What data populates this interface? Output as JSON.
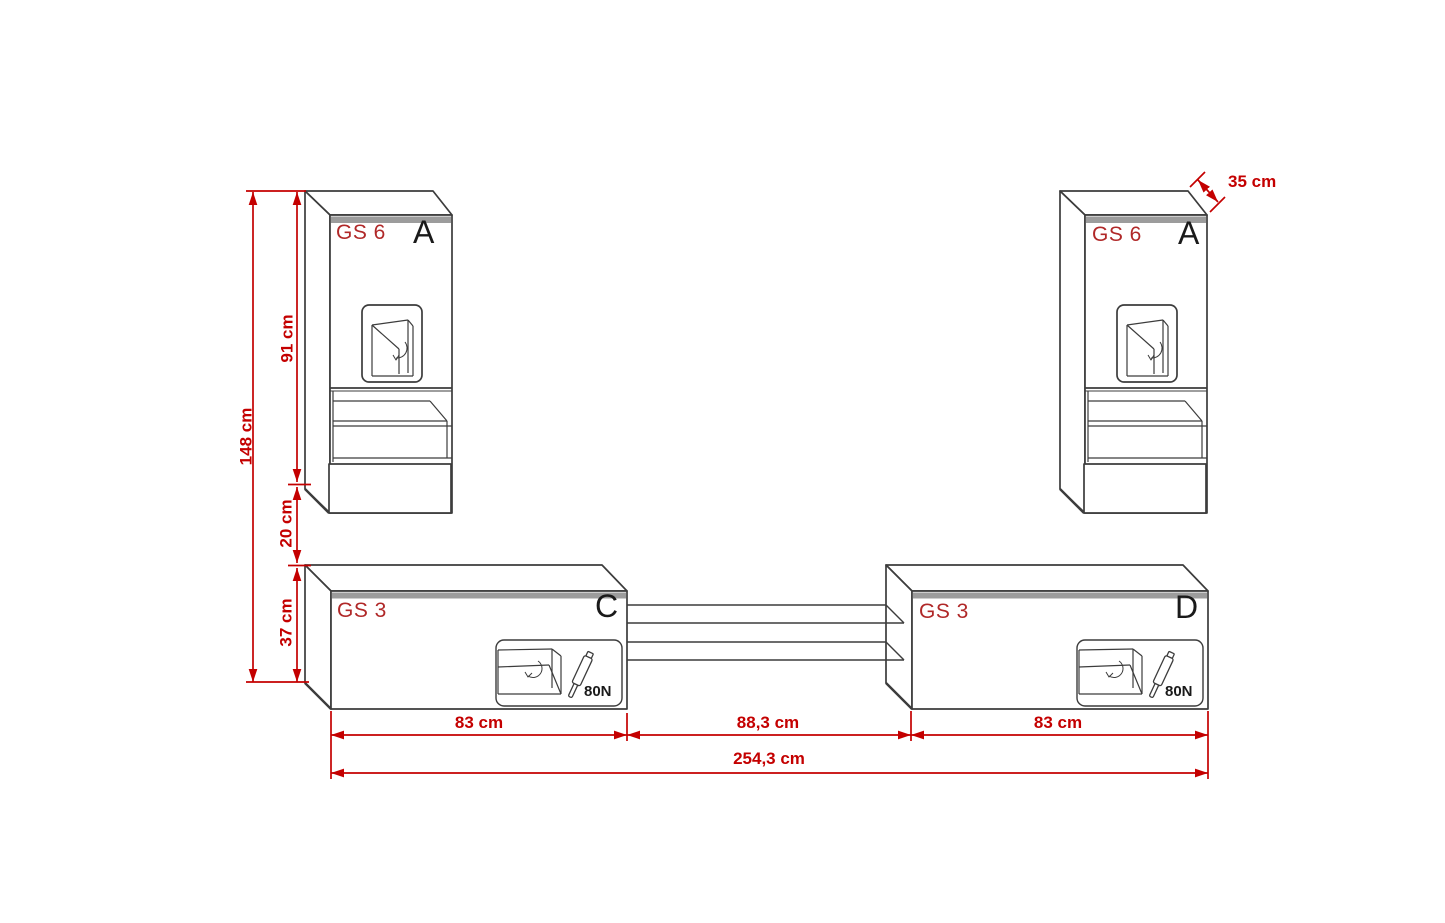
{
  "title": "Wall unit furniture dimension drawing",
  "cabinets": {
    "tall_left": {
      "model": "GS 6",
      "letter": "A"
    },
    "tall_right": {
      "model": "GS 6",
      "letter": "A"
    },
    "low_left": {
      "model": "GS 3",
      "letter": "C",
      "gas_spring": "80N"
    },
    "low_right": {
      "model": "GS 3",
      "letter": "D",
      "gas_spring": "80N"
    }
  },
  "dimensions": {
    "total_height": "148 cm",
    "upper_cabinet_height": "91 cm",
    "gap_height": "20 cm",
    "lower_cabinet_height": "37 cm",
    "depth": "35 cm",
    "left_cabinet_width": "83 cm",
    "center_span": "88,3 cm",
    "right_cabinet_width": "83 cm",
    "total_width": "254,3 cm"
  },
  "colors": {
    "line": "#3c3c3c",
    "dimension_red": "#c40000",
    "model_label_red": "#b02828",
    "letter_black": "#1a1a1a",
    "top_band_gray": "#9c9c9c",
    "background": "#ffffff"
  }
}
